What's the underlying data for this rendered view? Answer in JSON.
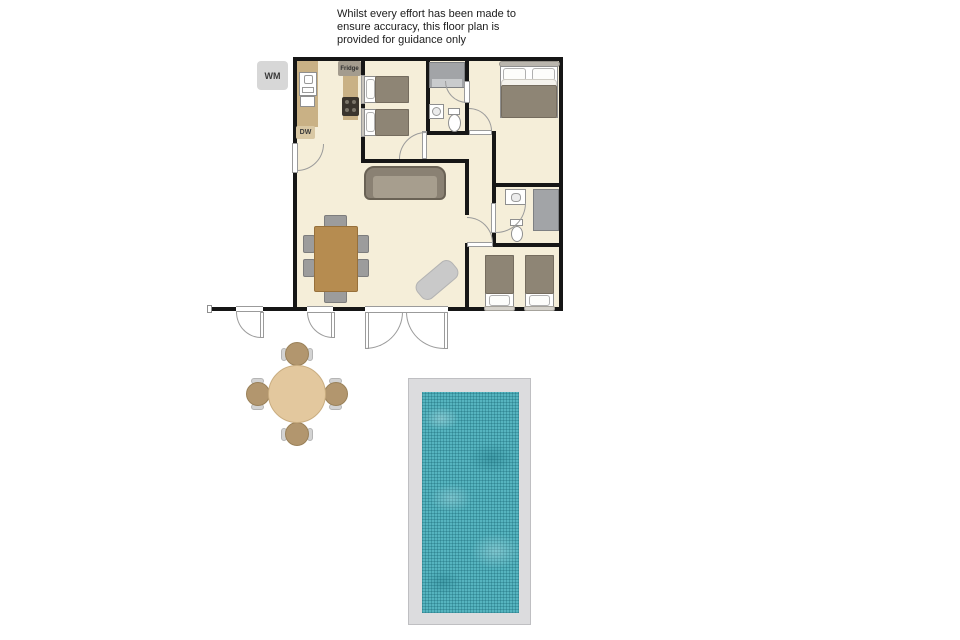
{
  "disclaimer": {
    "text": "Whilst every effort has been made to\nensure accuracy, this floor plan is\nprovided for guidance only"
  },
  "labels": {
    "washing_machine": "WM",
    "dishwasher": "DW",
    "fridge": "Fridge"
  },
  "palette": {
    "floor": "#f5eed9",
    "wall": "#161616",
    "counter": "#c9b185",
    "wood_table": "#b68c50",
    "chair_gray": "#9c9c9c",
    "sofa": "#8a8173",
    "sofa_seat": "#a79e8e",
    "bed_duvet": "#8e8575",
    "fixture_gray": "#a2a4a7",
    "rug": "#c9c9c9",
    "pool_deck": "#dcdcde",
    "pool_water": "#56b4bf",
    "patio_table": "#e3c89e",
    "patio_chair": "#b2966e",
    "wm_box": "#d7d7d7",
    "dw_box": "#d9c8a4",
    "fridge_box": "#a49c8e"
  }
}
